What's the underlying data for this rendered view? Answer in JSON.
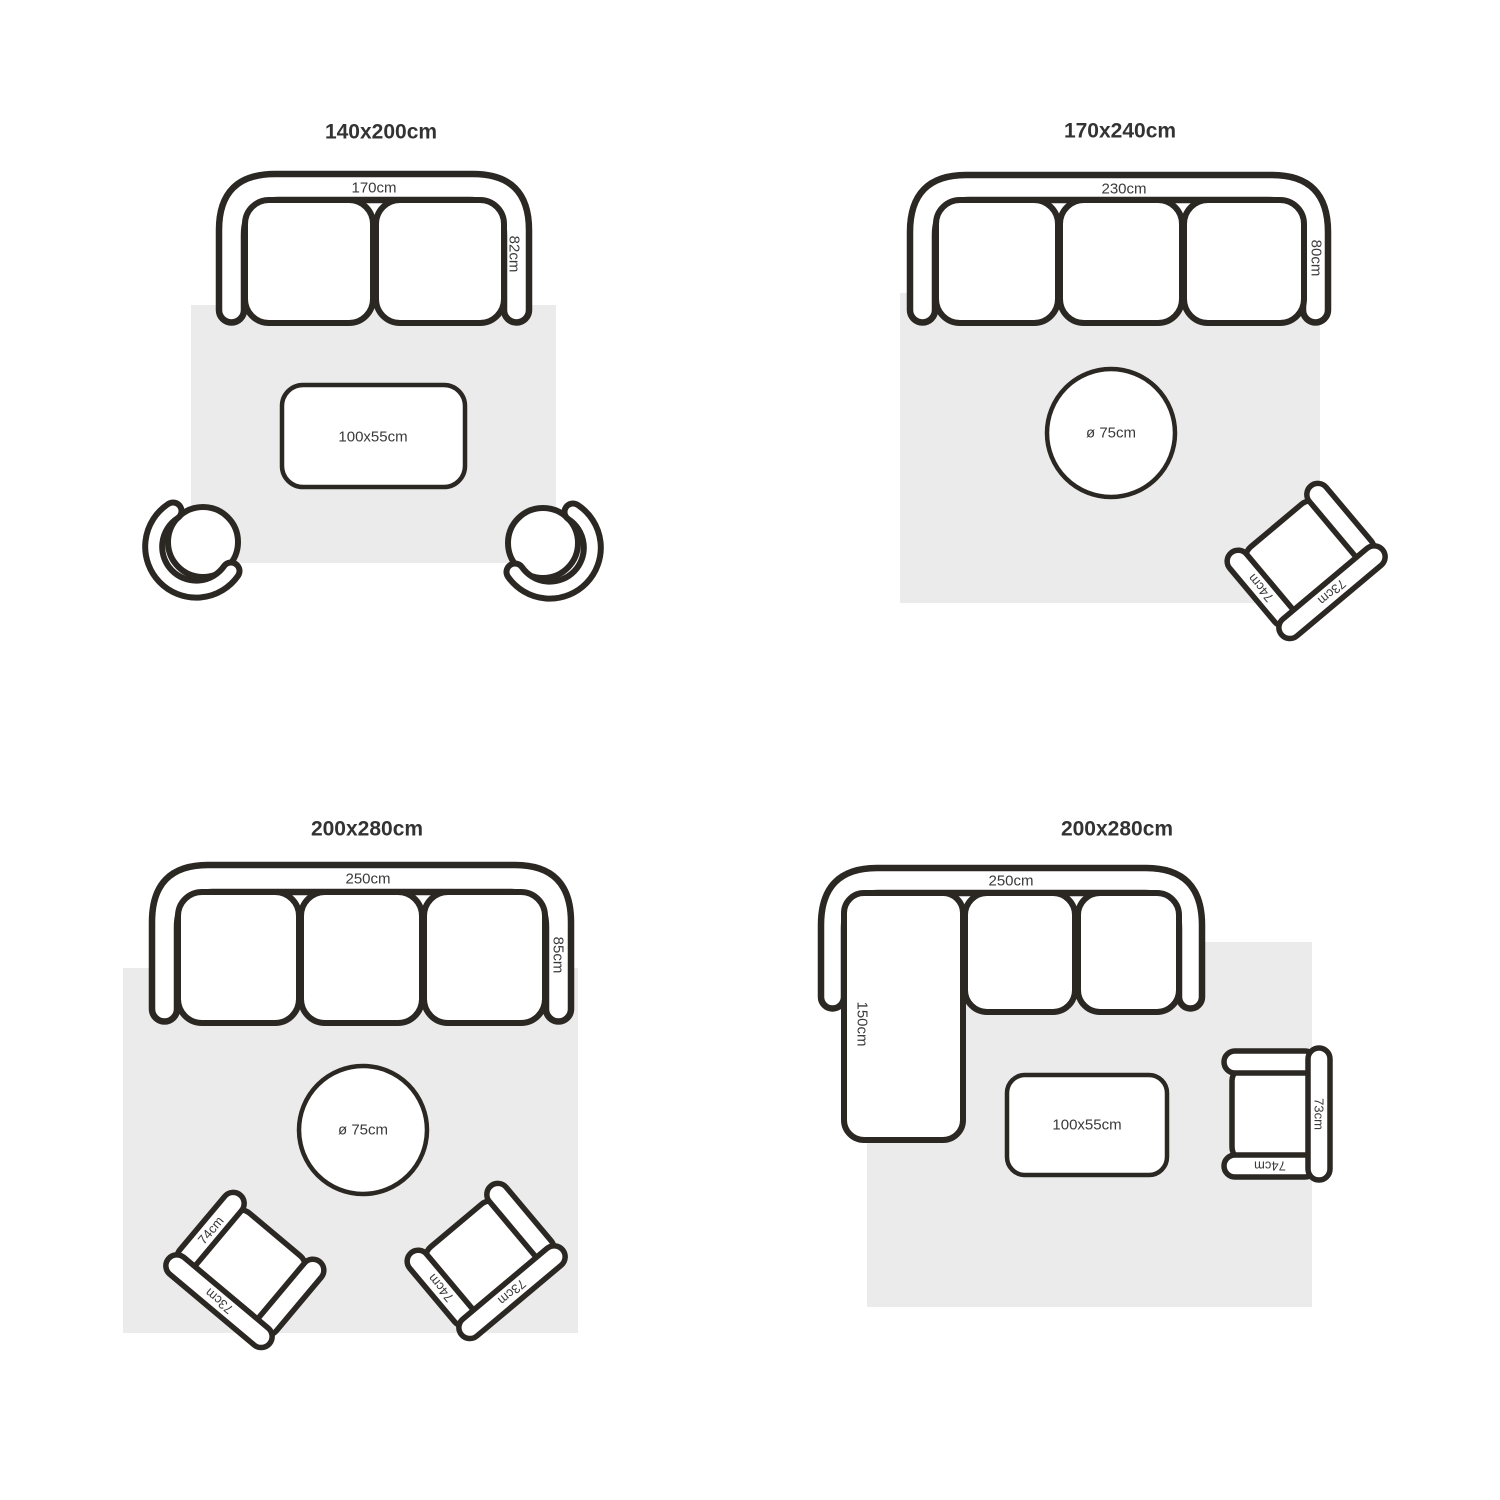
{
  "colors": {
    "background": "#ffffff",
    "line": "#2b2723",
    "rug": "#ebebeb",
    "label_text": "#3a3a3a",
    "title_text": "#333333"
  },
  "layouts": [
    {
      "title": "140x200cm",
      "sofa_width": "170cm",
      "sofa_depth": "82cm",
      "table": "100x55cm"
    },
    {
      "title": "170x240cm",
      "sofa_width": "230cm",
      "sofa_depth": "80cm",
      "table": "ø 75cm",
      "chair_arm": "74cm",
      "chair_back": "73cm"
    },
    {
      "title": "200x280cm",
      "sofa_width": "250cm",
      "sofa_depth": "85cm",
      "table": "ø 75cm",
      "chair_left_arm": "74cm",
      "chair_left_back": "73cm",
      "chair_right_arm": "74cm",
      "chair_right_back": "73cm"
    },
    {
      "title": "200x280cm",
      "sofa_width": "250cm",
      "chaise_length": "150cm",
      "table": "100x55cm",
      "chair_arm": "74cm",
      "chair_back": "73cm"
    }
  ]
}
